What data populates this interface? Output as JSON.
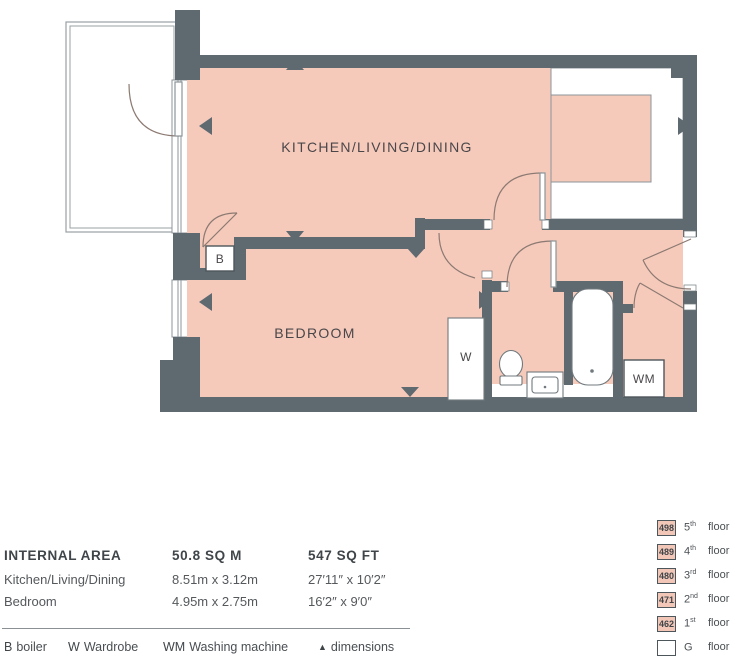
{
  "plan": {
    "room_labels": {
      "kitchen_living_dining": "KITCHEN/LIVING/DINING",
      "bedroom": "BEDROOM"
    },
    "fixture_labels": {
      "boiler": "B",
      "wardrobe": "W",
      "washing_machine": "WM"
    }
  },
  "area_table": {
    "title": "INTERNAL AREA",
    "metric_total": "50.8 SQ M",
    "imperial_total": "547 SQ FT",
    "rows": [
      {
        "room": "Kitchen/Living/Dining",
        "metric": "8.51m x 3.12m",
        "imperial": "27′11″ x 10′2″"
      },
      {
        "room": "Bedroom",
        "metric": "4.95m x 2.75m",
        "imperial": "16′2″ x 9′0″"
      }
    ]
  },
  "legend": [
    {
      "symbol": "B",
      "label": "boiler"
    },
    {
      "symbol": "W",
      "label": "Wardrobe"
    },
    {
      "symbol": "WM",
      "label": "Washing machine"
    },
    {
      "symbol": "▲",
      "label": "dimensions"
    }
  ],
  "floor_key": [
    {
      "unit": "498",
      "ordinal": "5",
      "suffix": "th",
      "label": "floor"
    },
    {
      "unit": "489",
      "ordinal": "4",
      "suffix": "th",
      "label": "floor"
    },
    {
      "unit": "480",
      "ordinal": "3",
      "suffix": "rd",
      "label": "floor"
    },
    {
      "unit": "471",
      "ordinal": "2",
      "suffix": "nd",
      "label": "floor"
    },
    {
      "unit": "462",
      "ordinal": "1",
      "suffix": "st",
      "label": "floor"
    },
    {
      "unit": "",
      "ordinal": "G",
      "suffix": "",
      "label": "floor"
    }
  ],
  "colors": {
    "room_fill": "#f6cabb",
    "wall": "#5f6a70",
    "accent_text": "#3f4549"
  }
}
